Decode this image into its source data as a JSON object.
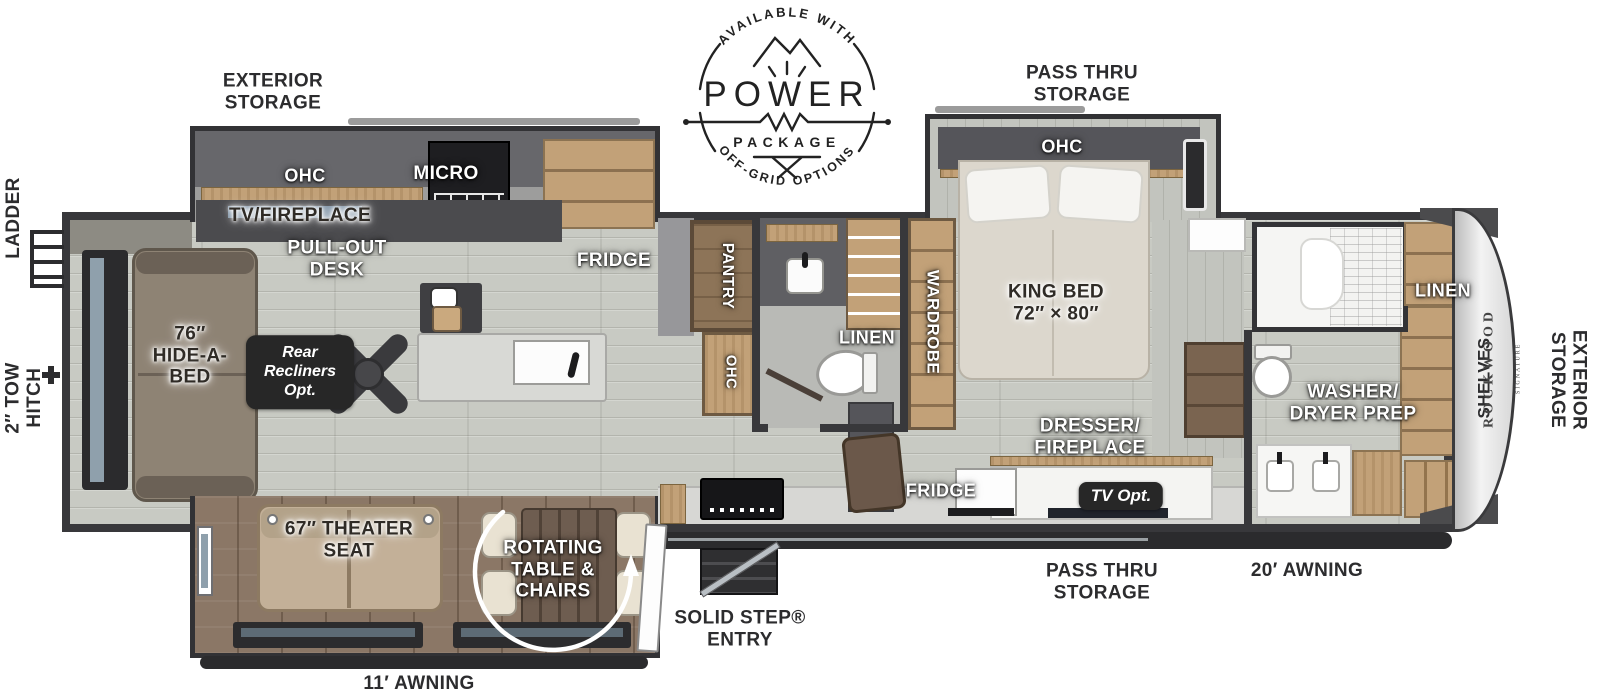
{
  "logo": {
    "arc_top": "AVAILABLE WITH",
    "name": "POWER",
    "package": "PACKAGE",
    "arc_bottom": "OFF-GRID OPTIONS"
  },
  "brand": {
    "name": "ROCKWOOD",
    "series": "SIGNATURE"
  },
  "exterior": {
    "storage_top": "EXTERIOR\nSTORAGE",
    "pass_thru_top": "PASS THRU\nSTORAGE",
    "ladder": "LADDER",
    "tow_hitch": "2″ TOW\nHITCH",
    "storage_front": "EXTERIOR\nSTORAGE",
    "pass_thru_bottom": "PASS THRU\nSTORAGE",
    "awning_door_side": "20′ AWNING",
    "awning_off_door_side": "11′ AWNING",
    "entry": "SOLID STEP®\nENTRY"
  },
  "interior": {
    "ohc_kitchen": "OHC",
    "micro": "MICRO",
    "tv_fireplace": "TV/FIREPLACE",
    "pull_out_desk": "PULL-OUT\nDESK",
    "fridge": "FRIDGE",
    "rear_recliners": "Rear\nRecliners\nOpt.",
    "hide_a_bed": "76″\nHIDE-A-\nBED",
    "theater_seat": "67″ THEATER\nSEAT",
    "rotating_table": "ROTATING\nTABLE &\nCHAIRS",
    "pantry": "PANTRY",
    "ohc_hall": "OHC",
    "linen_bath": "LINEN",
    "wardrobe": "WARDROBE",
    "ohc_bedroom": "OHC",
    "king_bed": "KING BED\n72″ × 80″",
    "dresser_fireplace": "DRESSER/\nFIREPLACE",
    "tv_opt": "TV Opt.",
    "fridge_entertainment": "FRIDGE",
    "washer_dryer": "WASHER/\nDRYER PREP",
    "linen_front": "LINEN",
    "shelves": "SHELVES"
  },
  "colors": {
    "wall": "#38383b",
    "floor": "#c8cac3",
    "slide_floor": "#8b7766",
    "cabinet_wood": "#c2a178",
    "badge": "#272727"
  }
}
